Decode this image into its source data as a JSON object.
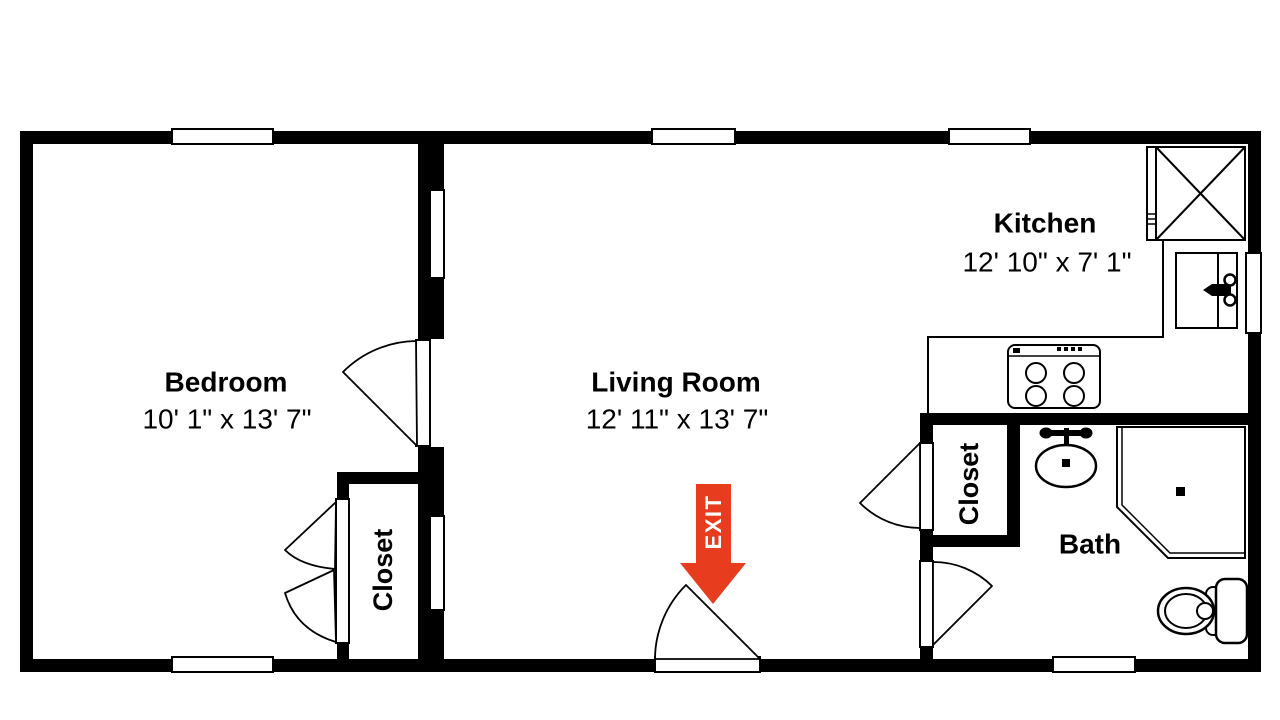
{
  "rooms": {
    "bedroom": {
      "name": "Bedroom",
      "dims": "10' 1\" x 13' 7\""
    },
    "living_room": {
      "name": "Living Room",
      "dims": "12' 11\" x 13' 7\""
    },
    "kitchen": {
      "name": "Kitchen",
      "dims": "12' 10\" x 7' 1\""
    },
    "bath": {
      "name": "Bath"
    },
    "bedroom_closet": {
      "name": "Closet"
    },
    "bath_closet": {
      "name": "Closet"
    }
  },
  "exit": {
    "label": "EXIT",
    "arrow_color": "#E73C1E"
  },
  "colors": {
    "background": "#FFFFFF",
    "walls": "#000000",
    "lines": "#000000"
  },
  "fixtures": {
    "kitchen": [
      "cabinet-x",
      "kitchen-sink",
      "stove"
    ],
    "bath": [
      "shower",
      "bath-sink",
      "toilet"
    ]
  }
}
